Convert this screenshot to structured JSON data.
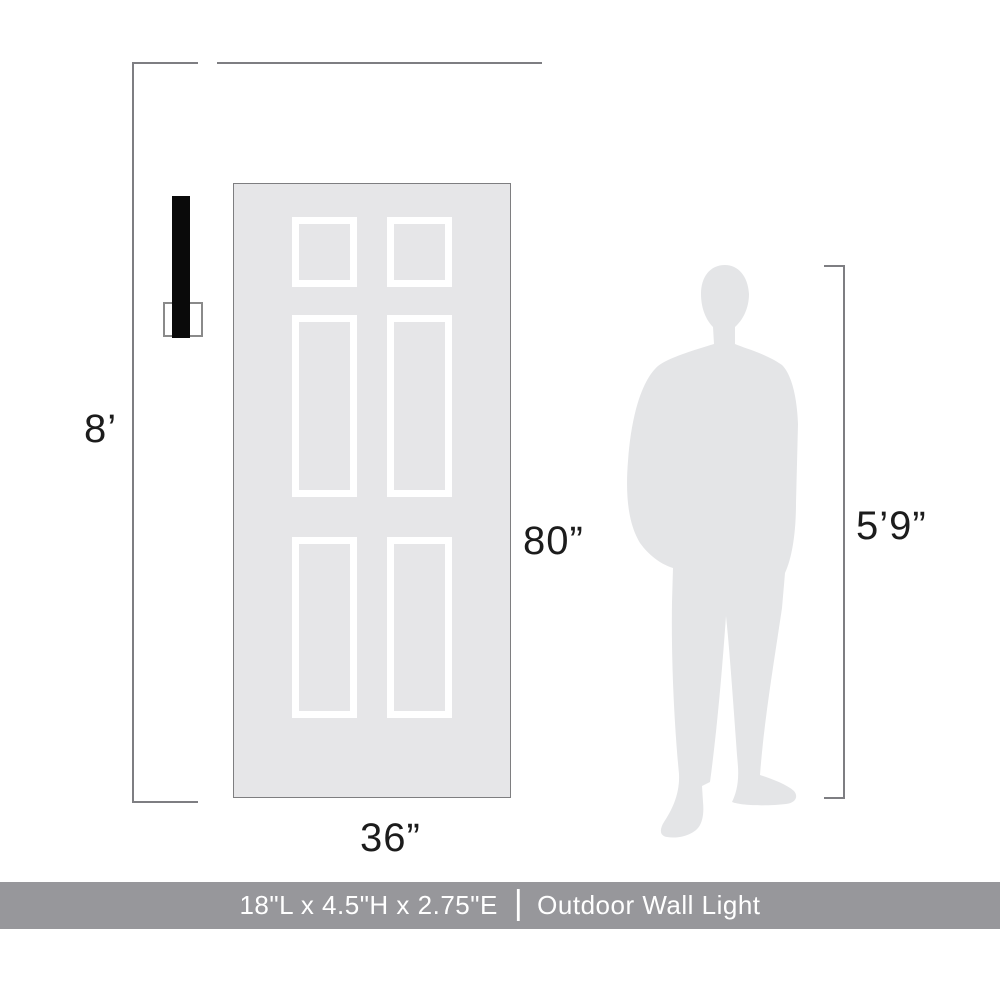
{
  "labels": {
    "ceiling_height": "8’",
    "door_height": "80”",
    "door_width": "36”",
    "person_height": "5’9”"
  },
  "banner": {
    "dimensions": "18\"L x 4.5\"H x 2.75\"E",
    "separator": "|",
    "product_name": "Outdoor Wall Light"
  },
  "icons": {
    "door": "six-panel-door-graphic",
    "person": "male-silhouette-graphic",
    "fixture": "outdoor-wall-light-graphic"
  },
  "colors": {
    "door_fill": "#E6E6E8",
    "door_border": "#7E7E80",
    "panel_frame": "#FFFFFF",
    "silhouette": "#E4E5E7",
    "fixture": "#0A0A0A",
    "dimension_line": "#7E7E82",
    "label_text": "#1C1C1C",
    "banner_bg": "#97979B",
    "banner_text": "#FFFFFF"
  }
}
